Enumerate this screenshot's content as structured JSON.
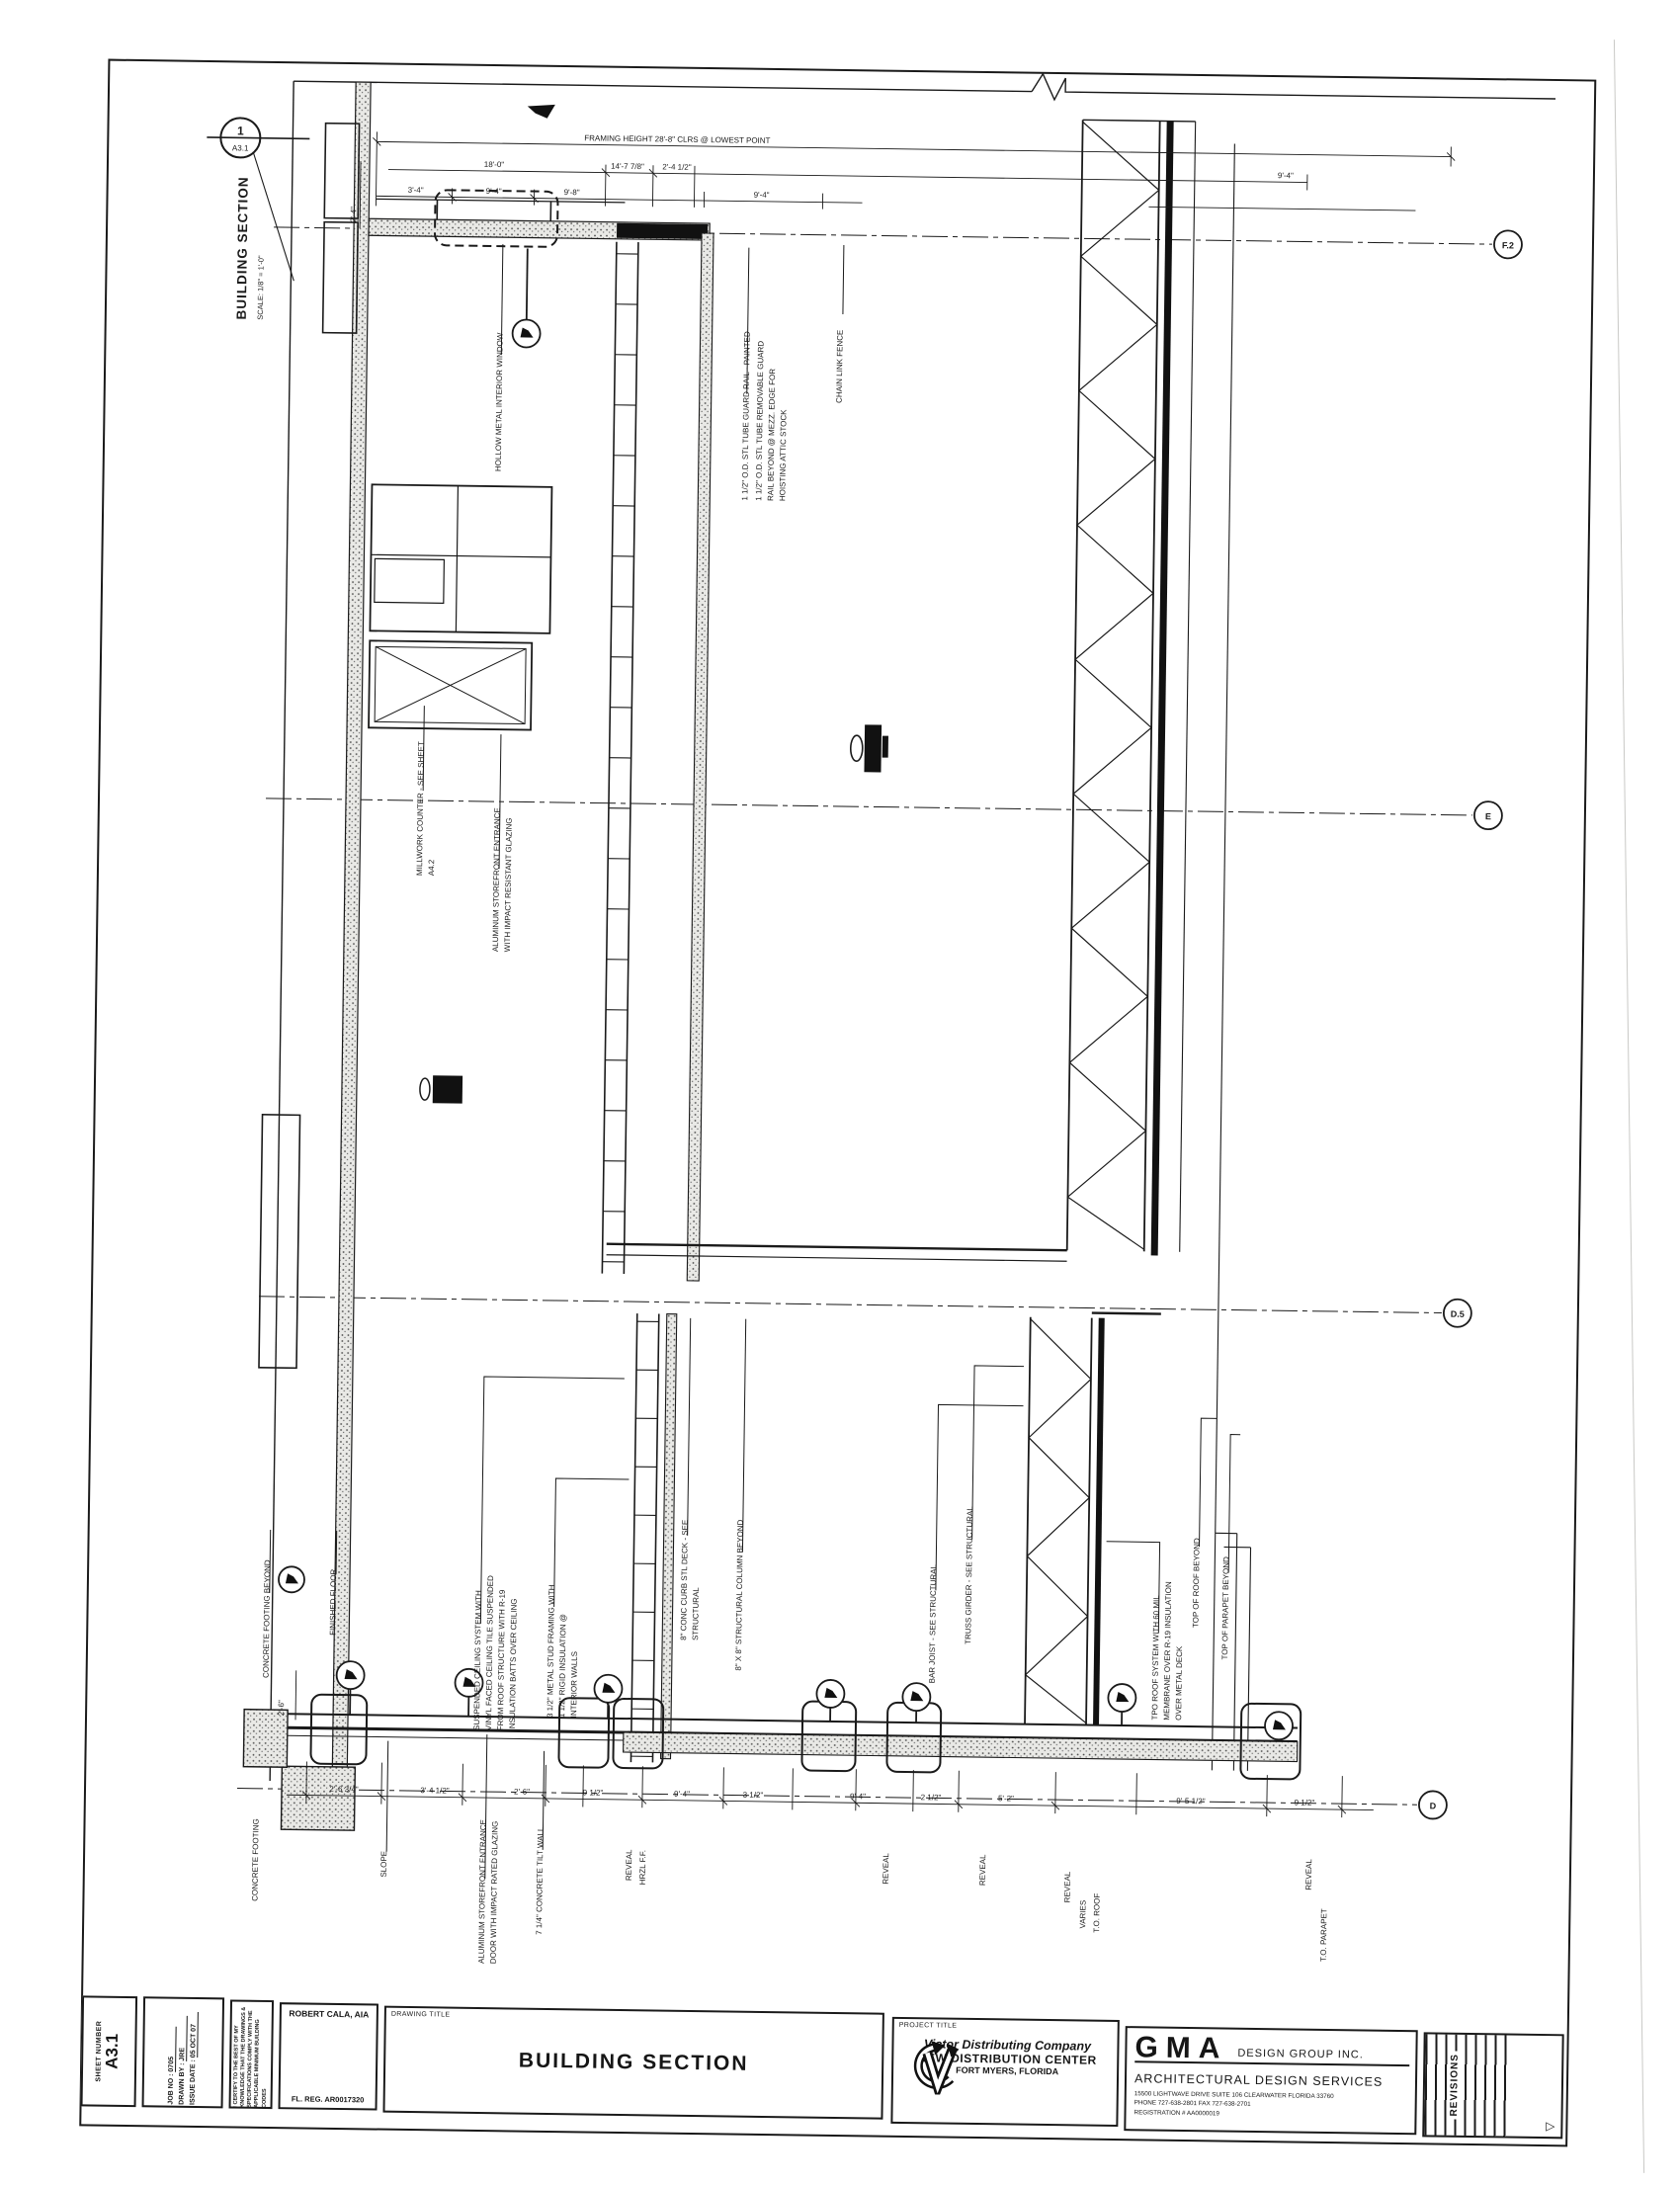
{
  "section_marker": {
    "number": "1",
    "sheet_ref": "A3.1",
    "title": "BUILDING SECTION",
    "scale": "SCALE: 1/8\" = 1'-0\""
  },
  "grid_bubbles": [
    "F.2",
    "E",
    "D.5",
    "D"
  ],
  "annotations": [
    "HOLLOW METAL INTERIOR WINDOW",
    "1 1/2\" O.D. STL TUBE GUARD RAIL - PAINTED",
    "1 1/2\" O.D. STL TUBE REMOVABLE GUARD",
    "RAIL BEYOND @ MEZZ. EDGE FOR",
    "HOISTING ATTIC STOCK",
    "CHAIN LINK FENCE",
    "MILLWORK COUNTER - SEE SHEET",
    "A4.2",
    "ALUMINUM STOREFRONT ENTRANCE",
    "WITH IMPACT RESISTANT GLAZING",
    "CONCRETE FOOTING BEYOND",
    "FINISHED FLOOR",
    "CONCRETE FOOTING",
    "SUSPENDED CEILING SYSTEM WITH",
    "VINYL FACED CEILING TILE SUSPENDED",
    "FROM ROOF STRUCTURE WITH R-19",
    "INSULATION BATTS OVER CEILING",
    "3 1/2\" METAL STUD FRAMING WITH",
    "1 1/2\" RIGID INSULATION @",
    "INTERIOR WALLS",
    "8\" CONC CURB STL DECK - SEE",
    "STRUCTURAL",
    "8\" X 8\" STRUCTURAL COLUMN BEYOND",
    "BAR JOIST - SEE STRUCTURAL",
    "TRUSS GIRDER - SEE STRUCTURAL",
    "TPO ROOF SYSTEM WITH 60 MIL",
    "MEMBRANE OVER R-19 INSULATION",
    "OVER METAL DECK",
    "TOP OF ROOF BEYOND",
    "TOP OF PARAPET BEYOND",
    "SLOPE",
    "ALUMINUM STOREFRONT ENTRANCE",
    "DOOR WITH IMPACT RATED GLAZING",
    "7 1/4\" CONCRETE TILT WALL",
    "REVEAL",
    "HRZL F.F.",
    "REVEAL",
    "REVEAL",
    "REVEAL",
    "VARIES",
    "T.O. ROOF",
    "REVEAL",
    "T.O. PARAPET",
    "2'-6\"",
    "2'-4\""
  ],
  "dims_top": [
    "FRAMING HEIGHT 28'-8\" CLRS @ LOWEST POINT",
    "18'-0\"",
    "14'-7 7/8\"",
    "2'-4 1/2\"",
    "3'-4\"",
    "9'-4\"",
    "9'-8\"",
    "9'-4\"",
    "9'-4\""
  ],
  "dims_bottom": [
    "2'-6 3/4\"",
    "3'-4 1/2\"",
    "2'-6\"",
    "9 1/2\"",
    "9'-4\"",
    "3 1/2\"",
    "9'-4\"",
    "2 1/2\"",
    "5'-2\"",
    "9'-5 1/2\"",
    "9 1/2\""
  ],
  "titleblock": {
    "sheet_number_label": "SHEET NUMBER",
    "sheet_number": "A3.1",
    "job_no_label": "JOB NO :",
    "job_no": "0705",
    "drawn_by_label": "DRAWN BY :",
    "drawn_by": "JRE",
    "issue_date_label": "ISSUE DATE :",
    "issue_date": "05 OCT 07",
    "certification": "I CERTIFY TO THE BEST OF MY KNOWLEDGE THAT THE DRAWINGS & SPECIFICATIONS COMPLY WITH THE APPLICABLE MINIMUM BUILDING CODES",
    "architect": "ROBERT CALA, AIA",
    "architect_reg": "FL. REG. AR0017320",
    "drawing_title_label": "DRAWING TITLE",
    "drawing_title": "BUILDING SECTION",
    "project_title_label": "PROJECT TITLE",
    "project_name": "Victor Distributing Company",
    "project_line2": "NEW DISTRIBUTION CENTER",
    "project_line3": "FORT MYERS, FLORIDA",
    "firm_name": "GMA",
    "firm_suffix": "DESIGN GROUP INC.",
    "firm_services": "ARCHITECTURAL DESIGN SERVICES",
    "firm_address": "15500 LIGHTWAVE DRIVE SUITE 106 CLEARWATER FLORIDA 33760",
    "firm_phone": "PHONE   727-638-2801      FAX   727-638-2701",
    "firm_registration": "REGISTRATION # AA0000019",
    "revisions_label": "REVISIONS"
  },
  "icons": {
    "revision_triangle": "▷"
  },
  "colors": {
    "ink": "#1a1a1a",
    "paper": "#ffffff"
  }
}
